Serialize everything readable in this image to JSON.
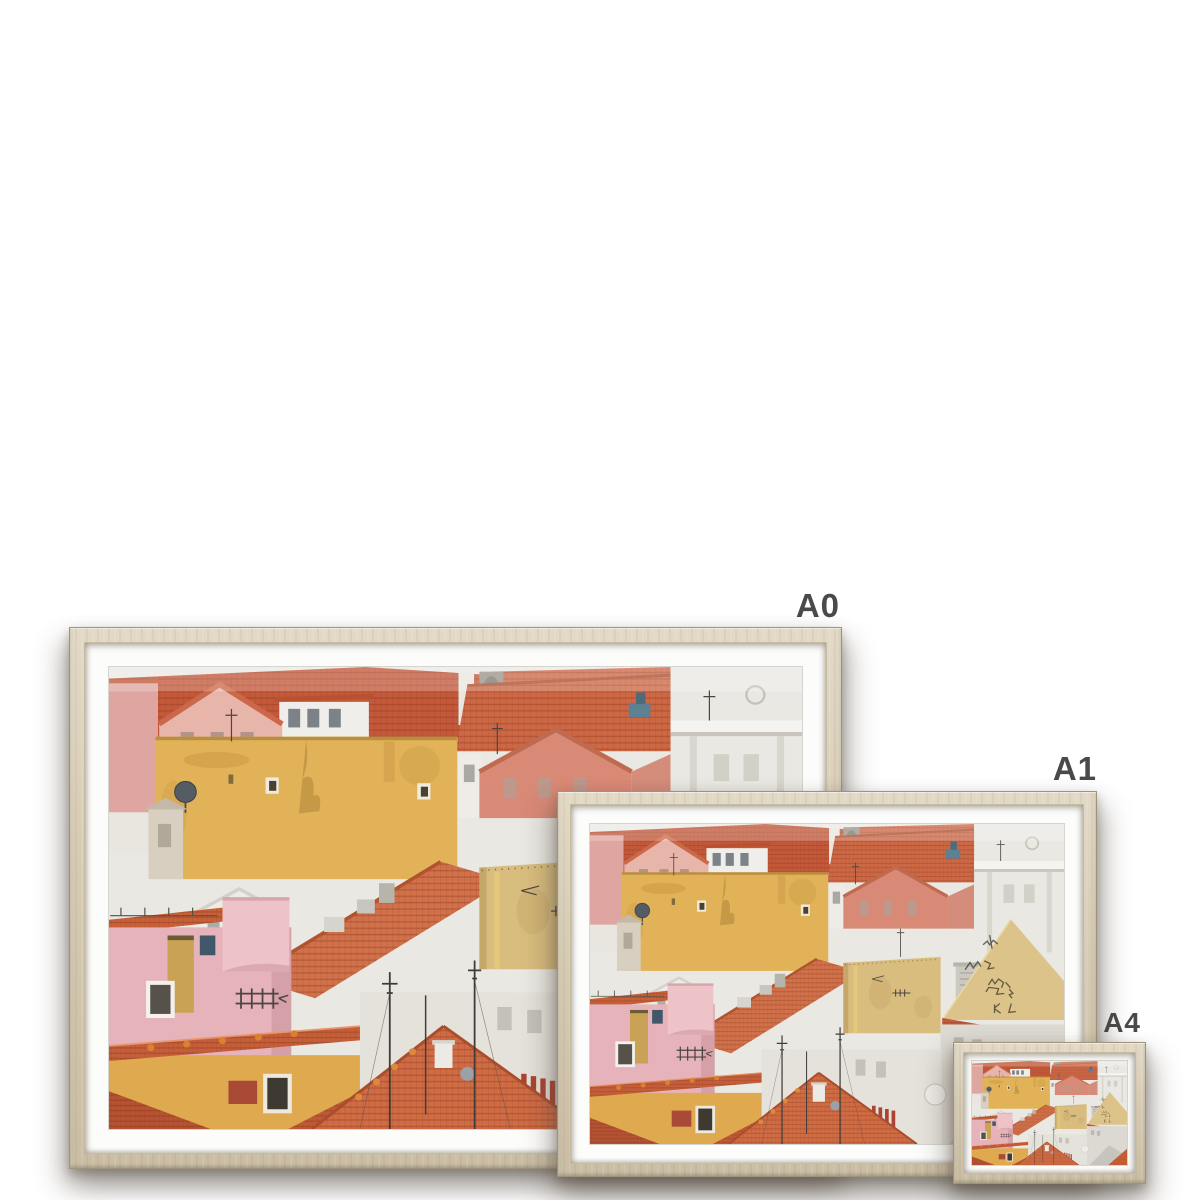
{
  "canvas": {
    "background_color": "#ffffff"
  },
  "sizes": [
    {
      "label": "A0"
    },
    {
      "label": "A1"
    },
    {
      "label": "A4"
    }
  ],
  "colors": {
    "canvas_background": "#ffffff",
    "label_text": "#4a4a4a",
    "frame_wood_light": "#e2d9c6",
    "frame_wood": "#d5cab3",
    "frame_wood_dark": "#c9bda4",
    "frame_edge": "#9e937c",
    "mat_white": "#fcfcfa",
    "photo_sky_white": "#eae8e3",
    "photo_ochre_wall": "#e2b259",
    "photo_sand_wall": "#d9bd7e",
    "photo_graffiti_wall": "#dcc389",
    "photo_pink_wall": "#e6b3ba",
    "photo_salmon_wall": "#d98a76",
    "photo_red_tile": "#c86038",
    "photo_orange_roof": "#cf6c44",
    "photo_white_building": "#eae8e3"
  }
}
